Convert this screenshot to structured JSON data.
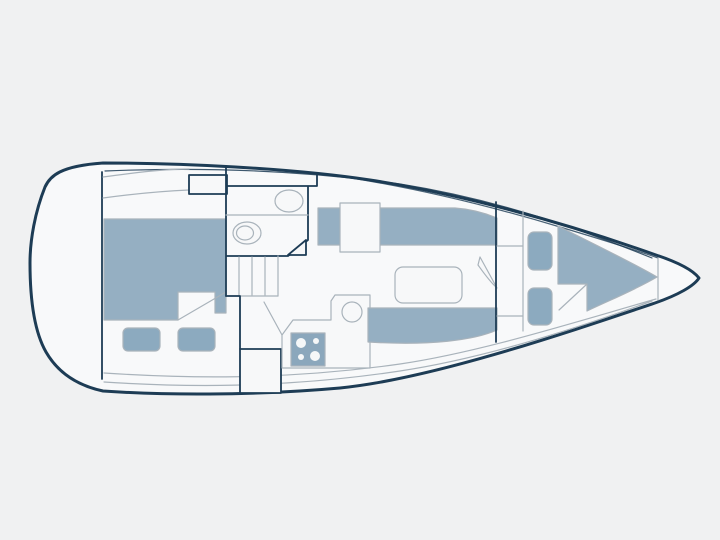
{
  "diagram": {
    "type": "sailboat-interior-floorplan",
    "view": "top-down",
    "bow_direction": "right",
    "visible_text": "",
    "colors": {
      "background": "#f0f1f2",
      "hull_fill": "#f8f9fa",
      "outline_dark": "#1d3c55",
      "outline_light": "#a9b3bb",
      "cushion_blue": "#95afc2",
      "pillow_blue": "#8caabf",
      "stove_blue": "#8ba7bc",
      "surface_white": "#f7f8f9",
      "burner_white": "#f5f7f8"
    },
    "parts": [
      "hull",
      "transom",
      "cockpit-bench-lines",
      "companionway-hatch",
      "aft-cabin-berth",
      "aft-cabin-pillow-left",
      "aft-cabin-pillow-right",
      "head-compartment",
      "head-sink",
      "head-toilet",
      "head-door",
      "companionway-steps",
      "quarter-locker",
      "stowage-locker",
      "galley-counter",
      "galley-sink",
      "galley-stove",
      "stove-burners",
      "chart-table",
      "salon-settee-port",
      "salon-settee-starboard",
      "salon-table",
      "forward-cabin-door",
      "forward-cabin-wardrobe",
      "forward-cabin-pillow-upper",
      "forward-cabin-pillow-lower",
      "v-berth",
      "anchor-locker-bulkhead"
    ]
  }
}
